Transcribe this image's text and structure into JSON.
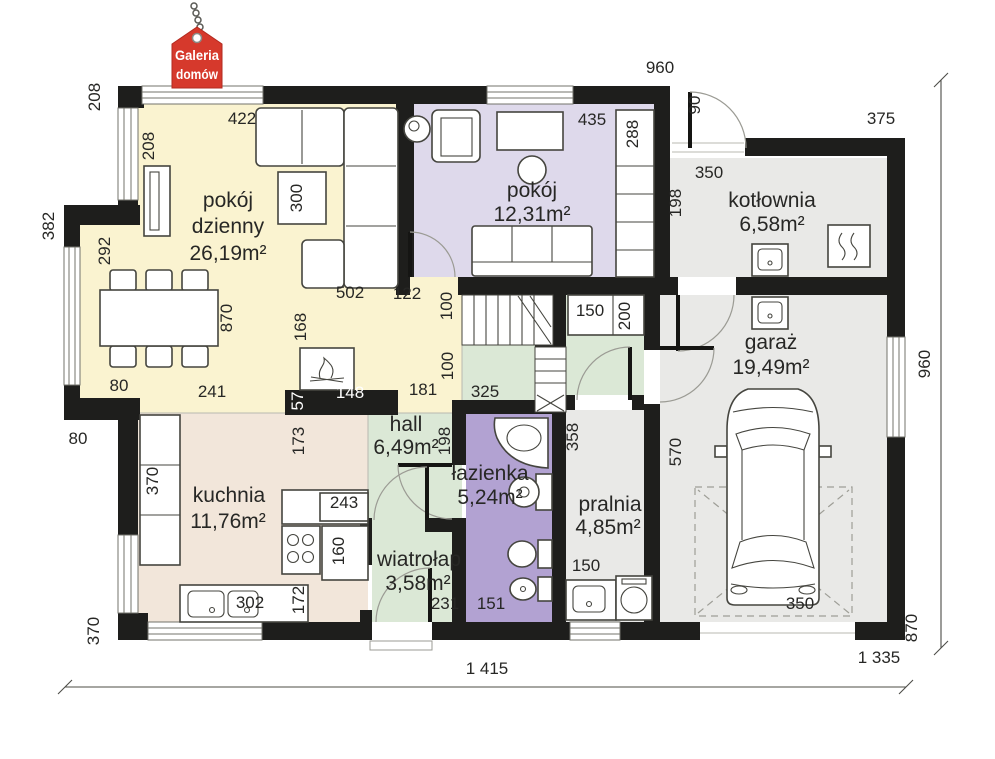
{
  "logo": {
    "line1": "Galeria",
    "line2": "domów",
    "tag_color": "#d6392c"
  },
  "colors": {
    "wall": "#1e1e1c",
    "living_room": "#faf3d0",
    "bedroom": "#ded9eb",
    "bathroom": "#b2a2d2",
    "hall_green": "#dbe8d6",
    "kitchen": "#f2e6da",
    "utility_gray": "#e9e9e7",
    "logo_red": "#d6392c"
  },
  "rooms": [
    {
      "id": "pokoj-dzienny",
      "name": "pokój dzienny",
      "area": "26,19m²",
      "label_lines": [
        {
          "t": "pokój",
          "x": 228,
          "y": 207
        },
        {
          "t": "dzienny",
          "x": 228,
          "y": 233
        },
        {
          "t": "26,19m²",
          "x": 228,
          "y": 260
        }
      ]
    },
    {
      "id": "pokoj",
      "name": "pokój",
      "area": "12,31m²",
      "label_lines": [
        {
          "t": "pokój",
          "x": 532,
          "y": 197
        },
        {
          "t": "12,31m²",
          "x": 532,
          "y": 221
        }
      ]
    },
    {
      "id": "kotlownia",
      "name": "kotłownia",
      "area": "6,58m²",
      "label_lines": [
        {
          "t": "kotłownia",
          "x": 772,
          "y": 207
        },
        {
          "t": "6,58m²",
          "x": 772,
          "y": 231
        }
      ]
    },
    {
      "id": "garaz",
      "name": "garaż",
      "area": "19,49m²",
      "label_lines": [
        {
          "t": "garaż",
          "x": 771,
          "y": 349
        },
        {
          "t": "19,49m²",
          "x": 771,
          "y": 374
        }
      ]
    },
    {
      "id": "kuchnia",
      "name": "kuchnia",
      "area": "11,76m²",
      "label_lines": [
        {
          "t": "kuchnia",
          "x": 229,
          "y": 502
        },
        {
          "t": "11,76m²",
          "x": 228,
          "y": 528
        }
      ]
    },
    {
      "id": "hall",
      "name": "hall",
      "area": "6,49m²",
      "label_lines": [
        {
          "t": "hall",
          "x": 406,
          "y": 431
        },
        {
          "t": "6,49m²",
          "x": 406,
          "y": 454
        }
      ]
    },
    {
      "id": "lazienka",
      "name": "łazienka",
      "area": "5,24m²",
      "label_lines": [
        {
          "t": "łazienka",
          "x": 490,
          "y": 480
        },
        {
          "t": "5,24m²",
          "x": 490,
          "y": 504
        }
      ]
    },
    {
      "id": "pralnia",
      "name": "pralnia",
      "area": "4,85m²",
      "label_lines": [
        {
          "t": "pralnia",
          "x": 610,
          "y": 511
        },
        {
          "t": "4,85m²",
          "x": 608,
          "y": 534
        }
      ]
    },
    {
      "id": "wiatrolap",
      "name": "wiatrołap",
      "area": "3,58m²",
      "label_lines": [
        {
          "t": "wiatrołap",
          "x": 419,
          "y": 566
        },
        {
          "t": "3,58m²",
          "x": 418,
          "y": 590
        }
      ]
    }
  ],
  "dimensions": [
    {
      "text": "208",
      "x": 100,
      "y": 97,
      "rot": -90
    },
    {
      "text": "422",
      "x": 242,
      "y": 124
    },
    {
      "text": "960",
      "x": 660,
      "y": 73
    },
    {
      "text": "90",
      "x": 700,
      "y": 105,
      "rot": -90
    },
    {
      "text": "375",
      "x": 881,
      "y": 124
    },
    {
      "text": "435",
      "x": 592,
      "y": 125
    },
    {
      "text": "288",
      "x": 638,
      "y": 134,
      "rot": -90
    },
    {
      "text": "208",
      "x": 154,
      "y": 146,
      "rot": -90
    },
    {
      "text": "300",
      "x": 302,
      "y": 198,
      "rot": -90
    },
    {
      "text": "350",
      "x": 709,
      "y": 178
    },
    {
      "text": "198",
      "x": 681,
      "y": 203,
      "rot": -90
    },
    {
      "text": "382",
      "x": 54,
      "y": 226,
      "rot": -90
    },
    {
      "text": "292",
      "x": 110,
      "y": 251,
      "rot": -90
    },
    {
      "text": "870",
      "x": 232,
      "y": 318,
      "rot": -90
    },
    {
      "text": "168",
      "x": 306,
      "y": 327,
      "rot": -90
    },
    {
      "text": "502",
      "x": 350,
      "y": 298
    },
    {
      "text": "122",
      "x": 407,
      "y": 299
    },
    {
      "text": "100",
      "x": 452,
      "y": 306,
      "rot": -90
    },
    {
      "text": "150",
      "x": 590,
      "y": 316
    },
    {
      "text": "200",
      "x": 630,
      "y": 316,
      "rot": -90
    },
    {
      "text": "100",
      "x": 453,
      "y": 366,
      "rot": -90
    },
    {
      "text": "960",
      "x": 930,
      "y": 364,
      "rot": -90
    },
    {
      "text": "80",
      "x": 119,
      "y": 391
    },
    {
      "text": "241",
      "x": 212,
      "y": 397
    },
    {
      "text": "57",
      "x": 303,
      "y": 401,
      "rot": -90,
      "white": true
    },
    {
      "text": "148",
      "x": 350,
      "y": 398,
      "white": true
    },
    {
      "text": "181",
      "x": 423,
      "y": 395
    },
    {
      "text": "325",
      "x": 485,
      "y": 397
    },
    {
      "text": "358",
      "x": 578,
      "y": 437,
      "rot": -90
    },
    {
      "text": "570",
      "x": 681,
      "y": 452,
      "rot": -90
    },
    {
      "text": "173",
      "x": 304,
      "y": 441,
      "rot": -90
    },
    {
      "text": "198",
      "x": 450,
      "y": 441,
      "rot": -90
    },
    {
      "text": "80",
      "x": 78,
      "y": 444
    },
    {
      "text": "370",
      "x": 158,
      "y": 481,
      "rot": -90
    },
    {
      "text": "243",
      "x": 344,
      "y": 508
    },
    {
      "text": "160",
      "x": 344,
      "y": 551,
      "rot": -90
    },
    {
      "text": "150",
      "x": 586,
      "y": 571
    },
    {
      "text": "172",
      "x": 304,
      "y": 600,
      "rot": -90
    },
    {
      "text": "302",
      "x": 250,
      "y": 608
    },
    {
      "text": "231",
      "x": 445,
      "y": 609
    },
    {
      "text": "151",
      "x": 491,
      "y": 609
    },
    {
      "text": "350",
      "x": 800,
      "y": 609
    },
    {
      "text": "370",
      "x": 99,
      "y": 631,
      "rot": -90
    },
    {
      "text": "870",
      "x": 917,
      "y": 628,
      "rot": -90
    },
    {
      "text": "1 415",
      "x": 487,
      "y": 674
    },
    {
      "text": "1 335",
      "x": 879,
      "y": 663
    }
  ]
}
